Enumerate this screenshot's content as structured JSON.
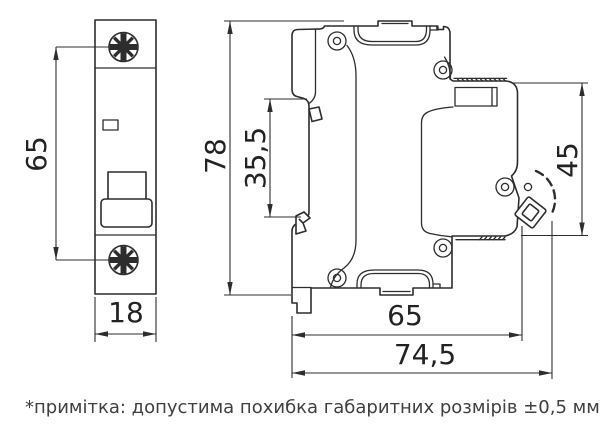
{
  "drawing": {
    "title_hint": "circuit breaker dimensional drawing",
    "front_view": {
      "dim_height": "65",
      "dim_width": "18"
    },
    "side_view": {
      "dim_overall_height": "78",
      "dim_face_height": "35,5",
      "dim_rail_section": "45",
      "dim_depth": "65",
      "dim_overall_depth": "74,5"
    },
    "note": "*примітка: допустима похибка габаритних розмірів ±0,5 мм.",
    "colors": {
      "line": "#2d2d2d",
      "note_text": "#3f3f3f",
      "background": "#ffffff"
    }
  }
}
